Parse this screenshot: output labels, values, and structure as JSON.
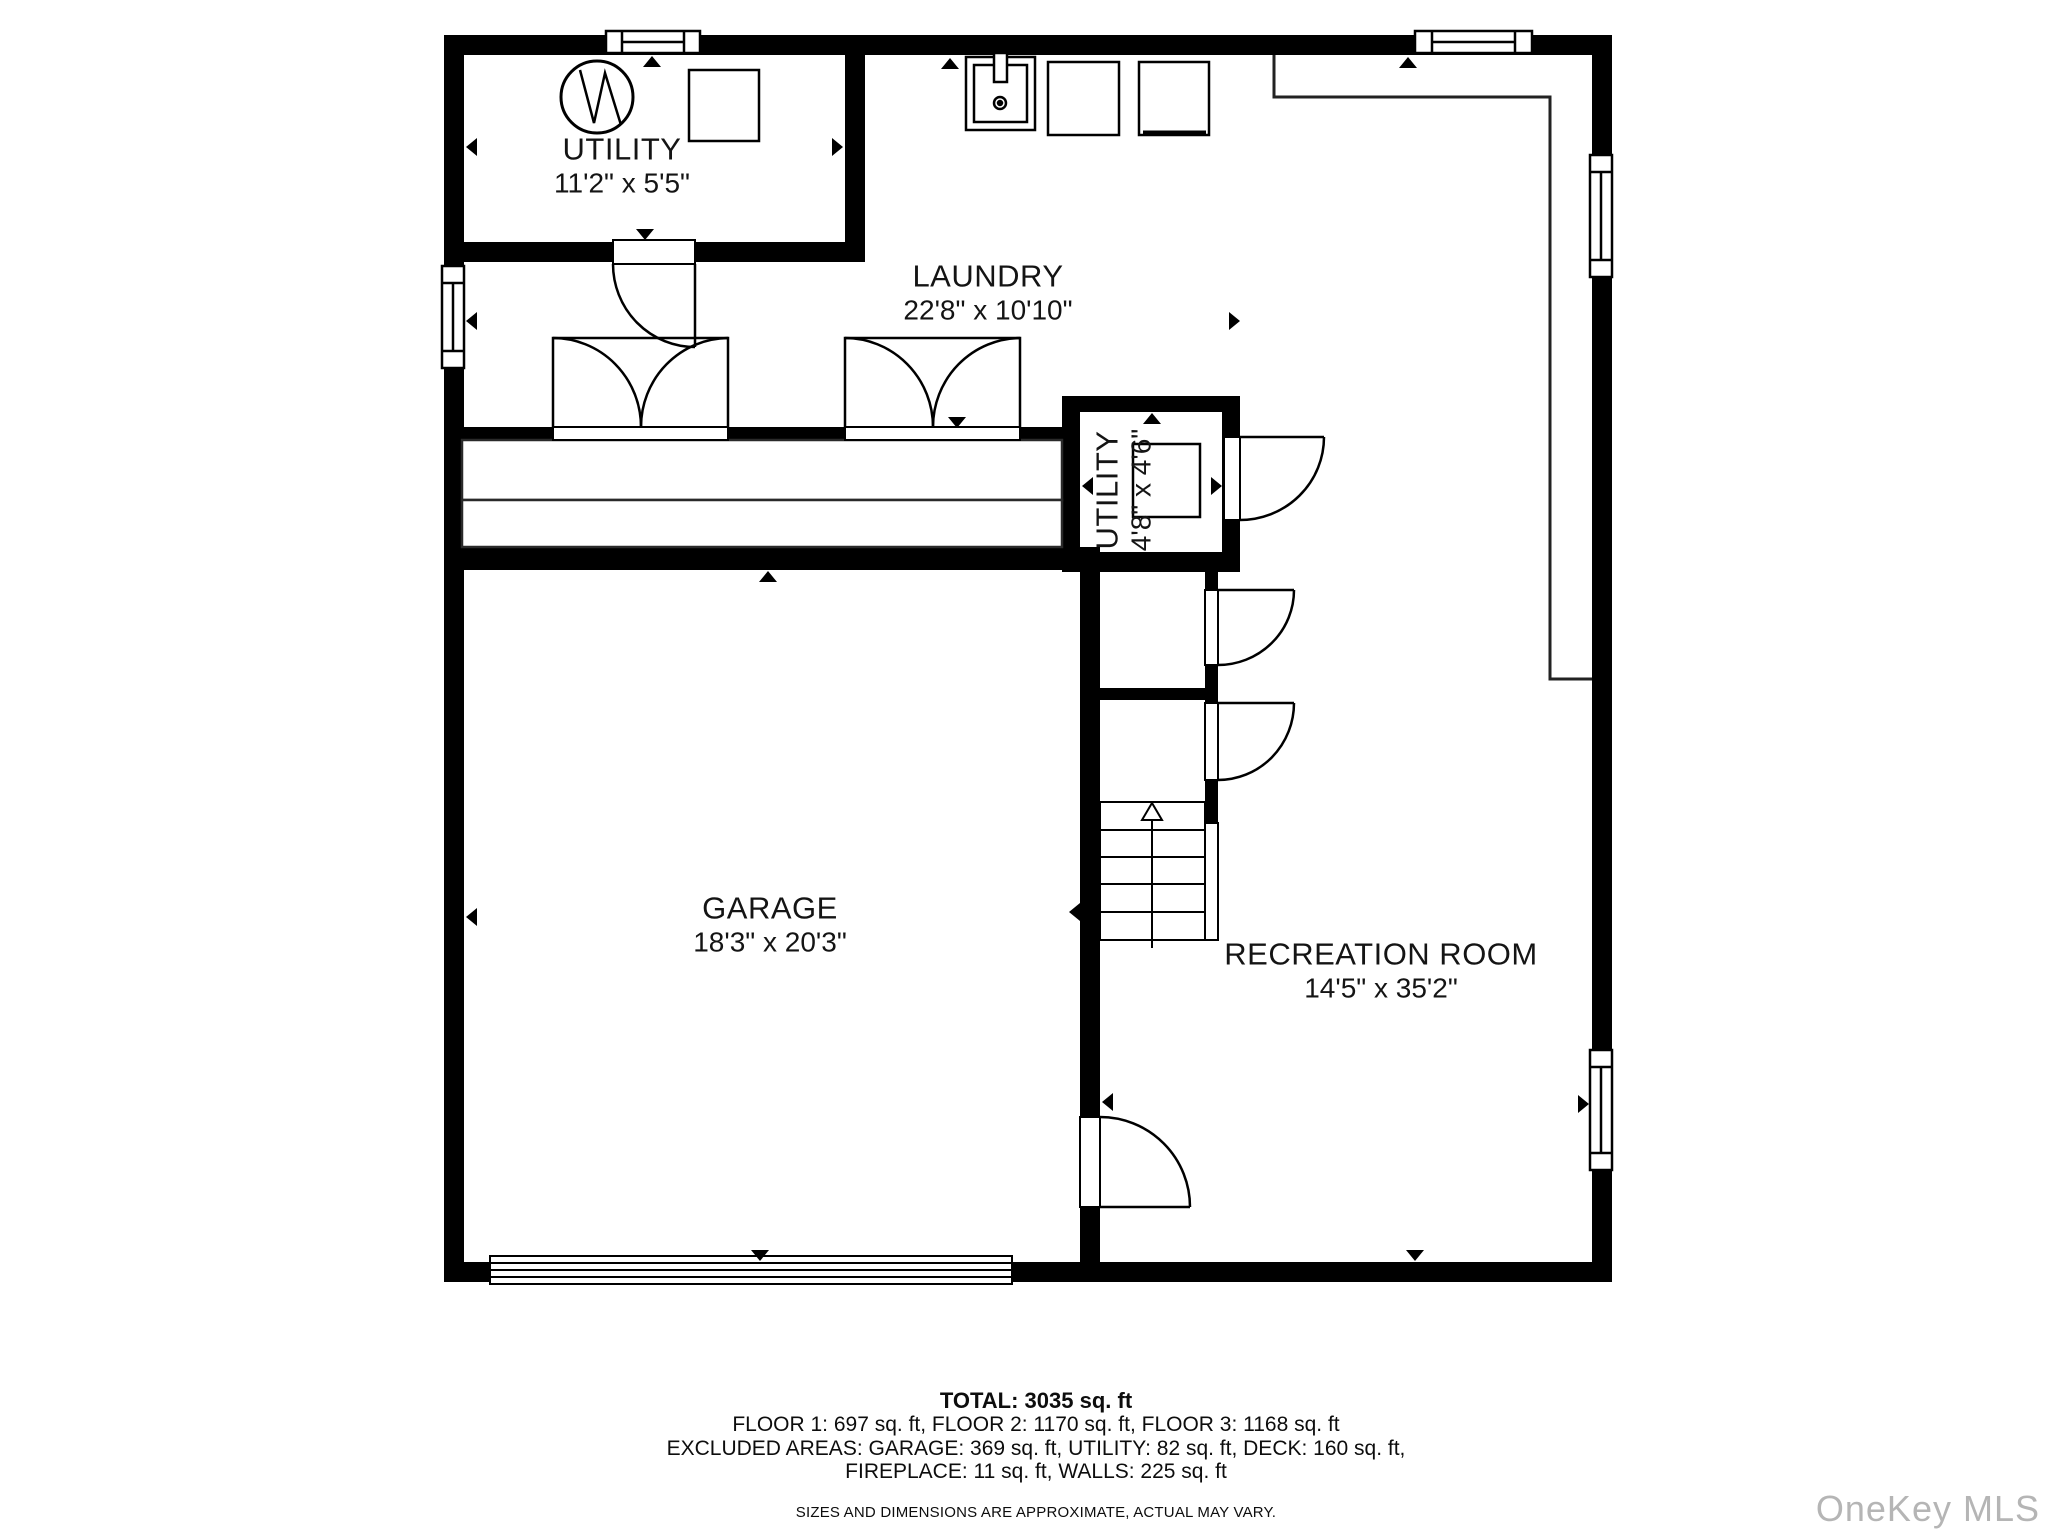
{
  "rooms": [
    {
      "name": "UTILITY",
      "dims": "11'2\" x 5'5\""
    },
    {
      "name": "LAUNDRY",
      "dims": "22'8\" x 10'10\""
    },
    {
      "name": "UTILITY",
      "dims": "4'8\" x 4'6\""
    },
    {
      "name": "GARAGE",
      "dims": "18'3\" x 20'3\""
    },
    {
      "name": "RECREATION ROOM",
      "dims": "14'5\" x 35'2\""
    }
  ],
  "footer": {
    "total": "TOTAL: 3035 sq. ft",
    "floors": "FLOOR 1: 697 sq. ft, FLOOR 2: 1170 sq. ft, FLOOR 3: 1168 sq. ft",
    "excluded_1": "EXCLUDED AREAS: GARAGE: 369 sq. ft, UTILITY: 82 sq. ft, DECK: 160 sq. ft,",
    "excluded_2": "FIREPLACE: 11 sq. ft, WALLS: 225 sq. ft",
    "disclaimer": "SIZES AND DIMENSIONS ARE APPROXIMATE, ACTUAL MAY VARY."
  },
  "watermark": "OneKey MLS",
  "colors": {
    "wall": "#000000",
    "line": "#1a1a1a",
    "watermark": "#b5b5b5"
  }
}
